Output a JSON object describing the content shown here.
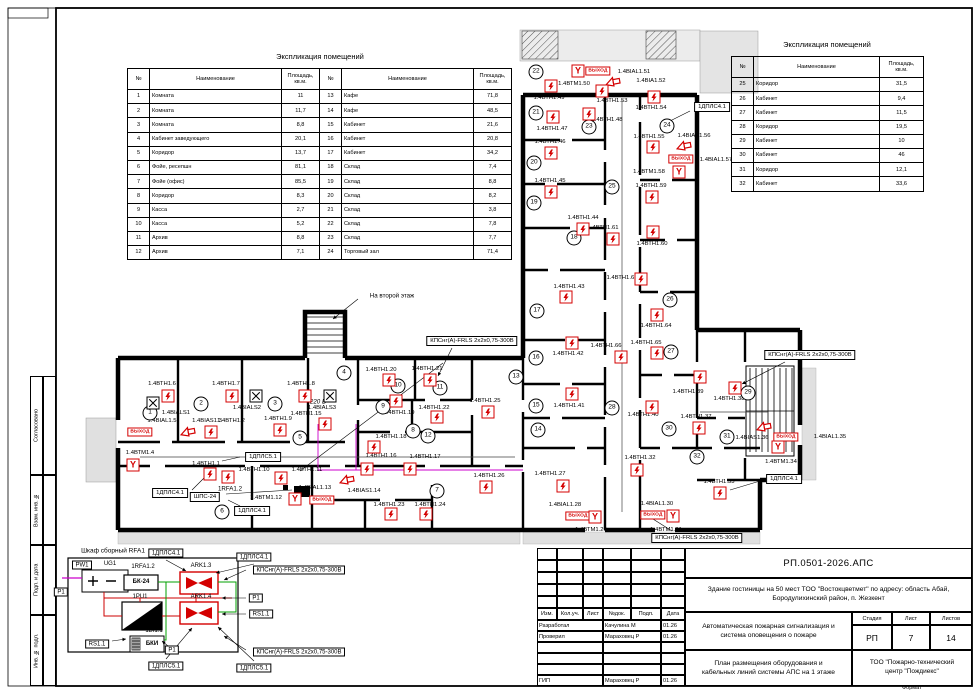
{
  "frame": {
    "side_labels": [
      "Согласовано",
      "Взам. инв. №",
      "Подп. и дата",
      "Инв. № подл."
    ],
    "format_label": "Формат"
  },
  "tables": {
    "header": [
      "№",
      "Наименование",
      "Площадь, кв.м."
    ],
    "left": {
      "title": "Экспликация помещений",
      "rows_a": [
        [
          "1",
          "Комната",
          "11"
        ],
        [
          "2",
          "Комната",
          "11,7"
        ],
        [
          "3",
          "Комната",
          "8,8"
        ],
        [
          "4",
          "Кабинет заведующего",
          "20,1"
        ],
        [
          "5",
          "Коридор",
          "13,7"
        ],
        [
          "6",
          "Фойе, ресепшн",
          "81,1"
        ],
        [
          "7",
          "Фойе (офис)",
          "85,5"
        ],
        [
          "8",
          "Коридор",
          "8,3"
        ],
        [
          "9",
          "Касса",
          "2,7"
        ],
        [
          "10",
          "Касса",
          "5,2"
        ],
        [
          "11",
          "Архив",
          "8,8"
        ],
        [
          "12",
          "Архив",
          "7,1"
        ]
      ],
      "rows_b": [
        [
          "13",
          "Кафе",
          "71,8"
        ],
        [
          "14",
          "Кафе",
          "48,5"
        ],
        [
          "15",
          "Кабинет",
          "21,6"
        ],
        [
          "16",
          "Кабинет",
          "20,8"
        ],
        [
          "17",
          "Кабинет",
          "34,2"
        ],
        [
          "18",
          "Склад",
          "7,4"
        ],
        [
          "19",
          "Склад",
          "8,8"
        ],
        [
          "20",
          "Склад",
          "8,2"
        ],
        [
          "21",
          "Склад",
          "3,8"
        ],
        [
          "22",
          "Склад",
          "7,8"
        ],
        [
          "23",
          "Склад",
          "7,7"
        ],
        [
          "24",
          "Торговый зал",
          "71,4"
        ]
      ]
    },
    "right": {
      "title": "Экспликация помещений",
      "rows": [
        [
          "25",
          "Коридор",
          "31,5"
        ],
        [
          "26",
          "Кабинет",
          "9,4"
        ],
        [
          "27",
          "Кабинет",
          "11,5"
        ],
        [
          "28",
          "Коридор",
          "19,5"
        ],
        [
          "29",
          "Кабинет",
          "10"
        ],
        [
          "30",
          "Кабинет",
          "46"
        ],
        [
          "31",
          "Коридор",
          "12,1"
        ],
        [
          "32",
          "Кабинет",
          "33,6"
        ]
      ]
    }
  },
  "plan": {
    "exit_text": "ВЫХОД",
    "devices": [
      {
        "t": "det",
        "x": 210,
        "y": 474,
        "l": "1.4ВТН1.1",
        "lx": 206,
        "ly": 464
      },
      {
        "t": "det",
        "x": 211,
        "y": 432,
        "l": "1.4ВТН1.2",
        "lx": 231,
        "ly": 421
      },
      {
        "t": "horn",
        "x": 188,
        "y": 433,
        "l": "1.4BIAS1.3",
        "lx": 207,
        "ly": 421
      },
      {
        "t": "man",
        "x": 133,
        "y": 465,
        "l": "1.4ВТМ1.4",
        "lx": 140,
        "ly": 453
      },
      {
        "t": "exit",
        "x": 140,
        "y": 432,
        "l": "1.4BIAL1.5",
        "lx": 162,
        "ly": 421
      },
      {
        "t": "det",
        "x": 168,
        "y": 396,
        "l": "1.4ВТН1.6",
        "lx": 162,
        "ly": 384
      },
      {
        "t": "det",
        "x": 232,
        "y": 396,
        "l": "1.4ВТН1.7",
        "lx": 226,
        "ly": 384
      },
      {
        "t": "det",
        "x": 305,
        "y": 396,
        "l": "1.4ВТН1.8",
        "lx": 301,
        "ly": 384
      },
      {
        "t": "xbox",
        "x": 153,
        "y": 403,
        "l": "1.4BIALS1",
        "lx": 176,
        "ly": 413
      },
      {
        "t": "xbox",
        "x": 256,
        "y": 396,
        "l": "1.4BIALS2",
        "lx": 247,
        "ly": 408
      },
      {
        "t": "xbox",
        "x": 330,
        "y": 396,
        "l": "1.4BIALS3",
        "lx": 322,
        "ly": 408
      },
      {
        "t": "det",
        "x": 280,
        "y": 430,
        "l": "1.4ВТН1.9",
        "lx": 278,
        "ly": 419
      },
      {
        "t": "det",
        "x": 228,
        "y": 477,
        "l": "1.4ВТН1.10",
        "lx": 254,
        "ly": 470
      },
      {
        "t": "det",
        "x": 281,
        "y": 478,
        "l": "1.4ВТН1.11",
        "lx": 307,
        "ly": 470
      },
      {
        "t": "man",
        "x": 295,
        "y": 499,
        "l": "1.4ВТМ1.12",
        "lx": 266,
        "ly": 498
      },
      {
        "t": "exit",
        "x": 322,
        "y": 500,
        "l": "1.4BIAL1.13",
        "lx": 315,
        "ly": 488
      },
      {
        "t": "horn",
        "x": 347,
        "y": 481,
        "l": "1.4BIAS1.14",
        "lx": 364,
        "ly": 491
      },
      {
        "t": "det",
        "x": 325,
        "y": 424,
        "l": "1.4ВТН1.15",
        "lx": 306,
        "ly": 414
      },
      {
        "t": "det",
        "x": 367,
        "y": 469,
        "l": "1.4ВТН1.16",
        "lx": 381,
        "ly": 456
      },
      {
        "t": "det",
        "x": 410,
        "y": 469,
        "l": "1.4ВТН1.17",
        "lx": 425,
        "ly": 457
      },
      {
        "t": "det",
        "x": 374,
        "y": 447,
        "l": "1.4ВТН1.18",
        "lx": 391,
        "ly": 437
      },
      {
        "t": "det",
        "x": 396,
        "y": 401,
        "l": "1.4ВТН1.19",
        "lx": 399,
        "ly": 413
      },
      {
        "t": "det",
        "x": 389,
        "y": 380,
        "l": "1.4ВТН1.20",
        "lx": 381,
        "ly": 370
      },
      {
        "t": "det",
        "x": 430,
        "y": 380,
        "l": "1.4ВТН1.21",
        "lx": 427,
        "ly": 369
      },
      {
        "t": "det",
        "x": 437,
        "y": 417,
        "l": "1.4ВТН1.22",
        "lx": 434,
        "ly": 408
      },
      {
        "t": "det",
        "x": 391,
        "y": 514,
        "l": "1.4ВТН1.23",
        "lx": 389,
        "ly": 505
      },
      {
        "t": "det",
        "x": 426,
        "y": 514,
        "l": "1.4ВТН1.24",
        "lx": 430,
        "ly": 505
      },
      {
        "t": "det",
        "x": 488,
        "y": 412,
        "l": "1.4ВТН1.25",
        "lx": 485,
        "ly": 401
      },
      {
        "t": "det",
        "x": 486,
        "y": 487,
        "l": "1.4ВТН1.26",
        "lx": 489,
        "ly": 476
      },
      {
        "t": "det",
        "x": 563,
        "y": 486,
        "l": "1.4ВТН1.27",
        "lx": 550,
        "ly": 474
      },
      {
        "t": "exit",
        "x": 578,
        "y": 516,
        "l": "1.4BIAL1.28",
        "lx": 565,
        "ly": 505
      },
      {
        "t": "man",
        "x": 595,
        "y": 517,
        "l": "1.4ВТМ1.29",
        "lx": 591,
        "ly": 530
      },
      {
        "t": "exit",
        "x": 653,
        "y": 515,
        "l": "1.4BIAL1.30",
        "lx": 657,
        "ly": 504
      },
      {
        "t": "man",
        "x": 673,
        "y": 516,
        "l": "1.4ВТМ1.31",
        "lx": 666,
        "ly": 530
      },
      {
        "t": "det",
        "x": 637,
        "y": 470,
        "l": "1.4ВТН1.32",
        "lx": 640,
        "ly": 458
      },
      {
        "t": "det",
        "x": 720,
        "y": 493,
        "l": "1.4ВТН1.33",
        "lx": 719,
        "ly": 482
      },
      {
        "t": "man",
        "x": 778,
        "y": 447,
        "l": "1.4ВТМ1.34",
        "lx": 781,
        "ly": 462
      },
      {
        "t": "exit",
        "x": 786,
        "y": 437,
        "l": "1.4BIAL1.35",
        "lx": 830,
        "ly": 437
      },
      {
        "t": "horn",
        "x": 764,
        "y": 428,
        "l": "1.4BIAS1.36",
        "lx": 752,
        "ly": 438
      },
      {
        "t": "det",
        "x": 699,
        "y": 428,
        "l": "1.4ВТН1.37",
        "lx": 696,
        "ly": 417
      },
      {
        "t": "det",
        "x": 735,
        "y": 388,
        "l": "1.4ВТН1.38",
        "lx": 729,
        "ly": 399
      },
      {
        "t": "det",
        "x": 700,
        "y": 377,
        "l": "1.4ВТН1.39",
        "lx": 688,
        "ly": 392
      },
      {
        "t": "det",
        "x": 652,
        "y": 407,
        "l": "1.4ВТН1.40",
        "lx": 643,
        "ly": 415
      },
      {
        "t": "det",
        "x": 572,
        "y": 394,
        "l": "1.4ВТН1.41",
        "lx": 569,
        "ly": 406
      },
      {
        "t": "det",
        "x": 572,
        "y": 343,
        "l": "1.4ВТН1.42",
        "lx": 568,
        "ly": 354
      },
      {
        "t": "det",
        "x": 566,
        "y": 297,
        "l": "1.4ВТН1.43",
        "lx": 569,
        "ly": 287
      },
      {
        "t": "det",
        "x": 583,
        "y": 229,
        "l": "1.4ВТН1.44",
        "lx": 583,
        "ly": 218
      },
      {
        "t": "det",
        "x": 551,
        "y": 192,
        "l": "1.4ВТН1.45",
        "lx": 550,
        "ly": 181
      },
      {
        "t": "det",
        "x": 551,
        "y": 153,
        "l": "1.4ВТН1.46",
        "lx": 550,
        "ly": 142
      },
      {
        "t": "det",
        "x": 553,
        "y": 117,
        "l": "1.4ВТН1.47",
        "lx": 552,
        "ly": 129
      },
      {
        "t": "det",
        "x": 589,
        "y": 114,
        "l": "1.4ВТН1.48",
        "lx": 607,
        "ly": 120
      },
      {
        "t": "det",
        "x": 551,
        "y": 86,
        "l": "1.4ВТН1.49",
        "lx": 549,
        "ly": 98
      },
      {
        "t": "man",
        "x": 578,
        "y": 71,
        "l": "1.4ВТМ1.50",
        "lx": 574,
        "ly": 84
      },
      {
        "t": "exit",
        "x": 598,
        "y": 71,
        "l": "1.4BIAL1.51",
        "lx": 634,
        "ly": 72
      },
      {
        "t": "horn",
        "x": 613,
        "y": 83,
        "l": "1.4BIA1.52",
        "lx": 651,
        "ly": 81
      },
      {
        "t": "det",
        "x": 602,
        "y": 91,
        "l": "1.4ВТН1.53",
        "lx": 612,
        "ly": 101
      },
      {
        "t": "det",
        "x": 654,
        "y": 97,
        "l": "1.4ВТН1.54",
        "lx": 651,
        "ly": 108
      },
      {
        "t": "det",
        "x": 653,
        "y": 147,
        "l": "1.4ВТН1.55",
        "lx": 649,
        "ly": 137
      },
      {
        "t": "horn",
        "x": 684,
        "y": 147,
        "l": "1.4BIAS1.56",
        "lx": 694,
        "ly": 136
      },
      {
        "t": "exit",
        "x": 681,
        "y": 159,
        "l": "1.4BIAL1.57",
        "lx": 716,
        "ly": 160
      },
      {
        "t": "man",
        "x": 679,
        "y": 172,
        "l": "1.4ВТМ1.58",
        "lx": 649,
        "ly": 172
      },
      {
        "t": "det",
        "x": 652,
        "y": 197,
        "l": "1.4ВТН1.59",
        "lx": 651,
        "ly": 186
      },
      {
        "t": "det",
        "x": 653,
        "y": 232,
        "l": "1.4ВТН1.60",
        "lx": 652,
        "ly": 244
      },
      {
        "t": "det",
        "x": 613,
        "y": 239,
        "l": "1.4ВТН1.61",
        "lx": 603,
        "ly": 228
      },
      {
        "t": "det",
        "x": 641,
        "y": 279,
        "l": "1.4ВТН1.63",
        "lx": 622,
        "ly": 278
      },
      {
        "t": "det",
        "x": 657,
        "y": 315,
        "l": "1.4ВТН1.64",
        "lx": 656,
        "ly": 326
      },
      {
        "t": "det",
        "x": 657,
        "y": 353,
        "l": "1.4ВТН1.65",
        "lx": 646,
        "ly": 343
      },
      {
        "t": "det",
        "x": 621,
        "y": 357,
        "l": "1.4ВТН1.66",
        "lx": 606,
        "ly": 346
      }
    ],
    "rooms": [
      [
        "1",
        150,
        413
      ],
      [
        "2",
        201,
        404
      ],
      [
        "3",
        275,
        404
      ],
      [
        "4",
        344,
        373
      ],
      [
        "5",
        300,
        438
      ],
      [
        "6",
        222,
        512
      ],
      [
        "7",
        437,
        491
      ],
      [
        "8",
        413,
        431
      ],
      [
        "9",
        383,
        407
      ],
      [
        "10",
        398,
        386
      ],
      [
        "11",
        440,
        388
      ],
      [
        "12",
        428,
        436
      ],
      [
        "13",
        516,
        377
      ],
      [
        "14",
        538,
        430
      ],
      [
        "15",
        536,
        406
      ],
      [
        "16",
        536,
        358
      ],
      [
        "17",
        537,
        311
      ],
      [
        "18",
        574,
        238
      ],
      [
        "19",
        534,
        203
      ],
      [
        "20",
        534,
        163
      ],
      [
        "21",
        536,
        113
      ],
      [
        "22",
        536,
        72
      ],
      [
        "23",
        589,
        127
      ],
      [
        "24",
        667,
        126
      ],
      [
        "25",
        612,
        187
      ],
      [
        "26",
        670,
        300
      ],
      [
        "27",
        671,
        352
      ],
      [
        "28",
        612,
        408
      ],
      [
        "29",
        748,
        393
      ],
      [
        "30",
        669,
        429
      ],
      [
        "31",
        727,
        437
      ],
      [
        "32",
        697,
        457
      ]
    ],
    "callouts": [
      {
        "x": 472,
        "y": 341,
        "l": "КПСнг(А)-FRLS 2x2x0,75-300В"
      },
      {
        "x": 810,
        "y": 355,
        "l": "КПСнг(А)-FRLS 2x2x0,75-300В"
      },
      {
        "x": 697,
        "y": 538,
        "l": "КПСнг(А)-FRLS 2x2x0,75-300В"
      },
      {
        "x": 712,
        "y": 107,
        "l": "1ДПЛС4.1"
      },
      {
        "x": 784,
        "y": 479,
        "l": "1ДПЛС4.1"
      },
      {
        "x": 170,
        "y": 493,
        "l": "1ДПЛС4.1"
      },
      {
        "x": 252,
        "y": 511,
        "l": "1ДПЛС4.1"
      },
      {
        "x": 263,
        "y": 457,
        "l": "1ДПЛС5.1"
      },
      {
        "x": 205,
        "y": 497,
        "l": "ШПС-24"
      }
    ],
    "notes": [
      {
        "x": 392,
        "y": 296,
        "l": "На второй этаж"
      },
      {
        "x": 318,
        "y": 402,
        "l": "220 В",
        "i": true
      },
      {
        "x": 230,
        "y": 489,
        "l": "1RFA1.2"
      }
    ]
  },
  "cabinet": {
    "title": "Шкаф сборный RFA1",
    "labels": [
      {
        "x": 82,
        "y": 565,
        "l": "PW1",
        "box": 1
      },
      {
        "x": 110,
        "y": 564,
        "l": "UG1"
      },
      {
        "x": 143,
        "y": 567,
        "l": "1RFA1.2"
      },
      {
        "x": 141,
        "y": 582,
        "l": "БК-24",
        "b": 1
      },
      {
        "x": 201,
        "y": 566,
        "l": "ARK1.3"
      },
      {
        "x": 201,
        "y": 597,
        "l": "ARK1.4"
      },
      {
        "x": 140,
        "y": 597,
        "l": "1PU1"
      },
      {
        "x": 154,
        "y": 631,
        "l": "1BI1.1"
      },
      {
        "x": 152,
        "y": 644,
        "l": "БКИ",
        "b": 1
      },
      {
        "x": 61,
        "y": 592,
        "l": "P1",
        "box": 1
      },
      {
        "x": 256,
        "y": 598,
        "l": "P1",
        "box": 1
      },
      {
        "x": 261,
        "y": 614,
        "l": "RS1.1",
        "box": 1
      },
      {
        "x": 97,
        "y": 644,
        "l": "RS1.1",
        "box": 1
      },
      {
        "x": 172,
        "y": 650,
        "l": "P1",
        "box": 1
      },
      {
        "x": 166,
        "y": 553,
        "l": "1ДПЛС4.1",
        "box": 1
      },
      {
        "x": 254,
        "y": 557,
        "l": "1ДПЛС4.1",
        "box": 1
      },
      {
        "x": 299,
        "y": 570,
        "l": "КПСнг(А)-FRLS 2x2x0,75-300В",
        "box": 1
      },
      {
        "x": 299,
        "y": 652,
        "l": "КПСнг(А)-FRLS 2x2x0,75-300В",
        "box": 1
      },
      {
        "x": 166,
        "y": 666,
        "l": "1ДПЛС5.1",
        "box": 1
      },
      {
        "x": 254,
        "y": 668,
        "l": "1ДПЛС5.1",
        "box": 1
      }
    ]
  },
  "titleblock": {
    "doc_code": "РП.0501-2026.АПС",
    "object": "Здание гостиницы на 50 мест ТОО \"Востокцветмет\" по адресу: область Абай, Бородулихинский район, п. Жезкент",
    "project_title": "Автоматическая пожарная сигнализация и система оповещения о пожаре",
    "sheet_title": "План размещения оборудования и кабельных линий системы АПС на 1 этаже",
    "company": "ТОО \"Пожарно-технический центр \"Пождиекс\"",
    "stage_label": "Стадия",
    "stage": "РП",
    "sheet_label": "Лист",
    "sheet": "7",
    "sheets_label": "Листов",
    "sheets": "14",
    "sig_header": [
      "Изм.",
      "Кол.уч.",
      "Лист",
      "№док.",
      "Подп.",
      "Дата"
    ],
    "sig_rows": [
      [
        "Разработал",
        "Качулина М",
        "01.26"
      ],
      [
        "Проверил",
        "Мараховец Р",
        "01.26"
      ],
      [
        "",
        "",
        ""
      ],
      [
        "",
        "",
        ""
      ],
      [
        "",
        "",
        ""
      ],
      [
        "ГИП",
        "Мараховец Р",
        "01.26"
      ]
    ]
  }
}
